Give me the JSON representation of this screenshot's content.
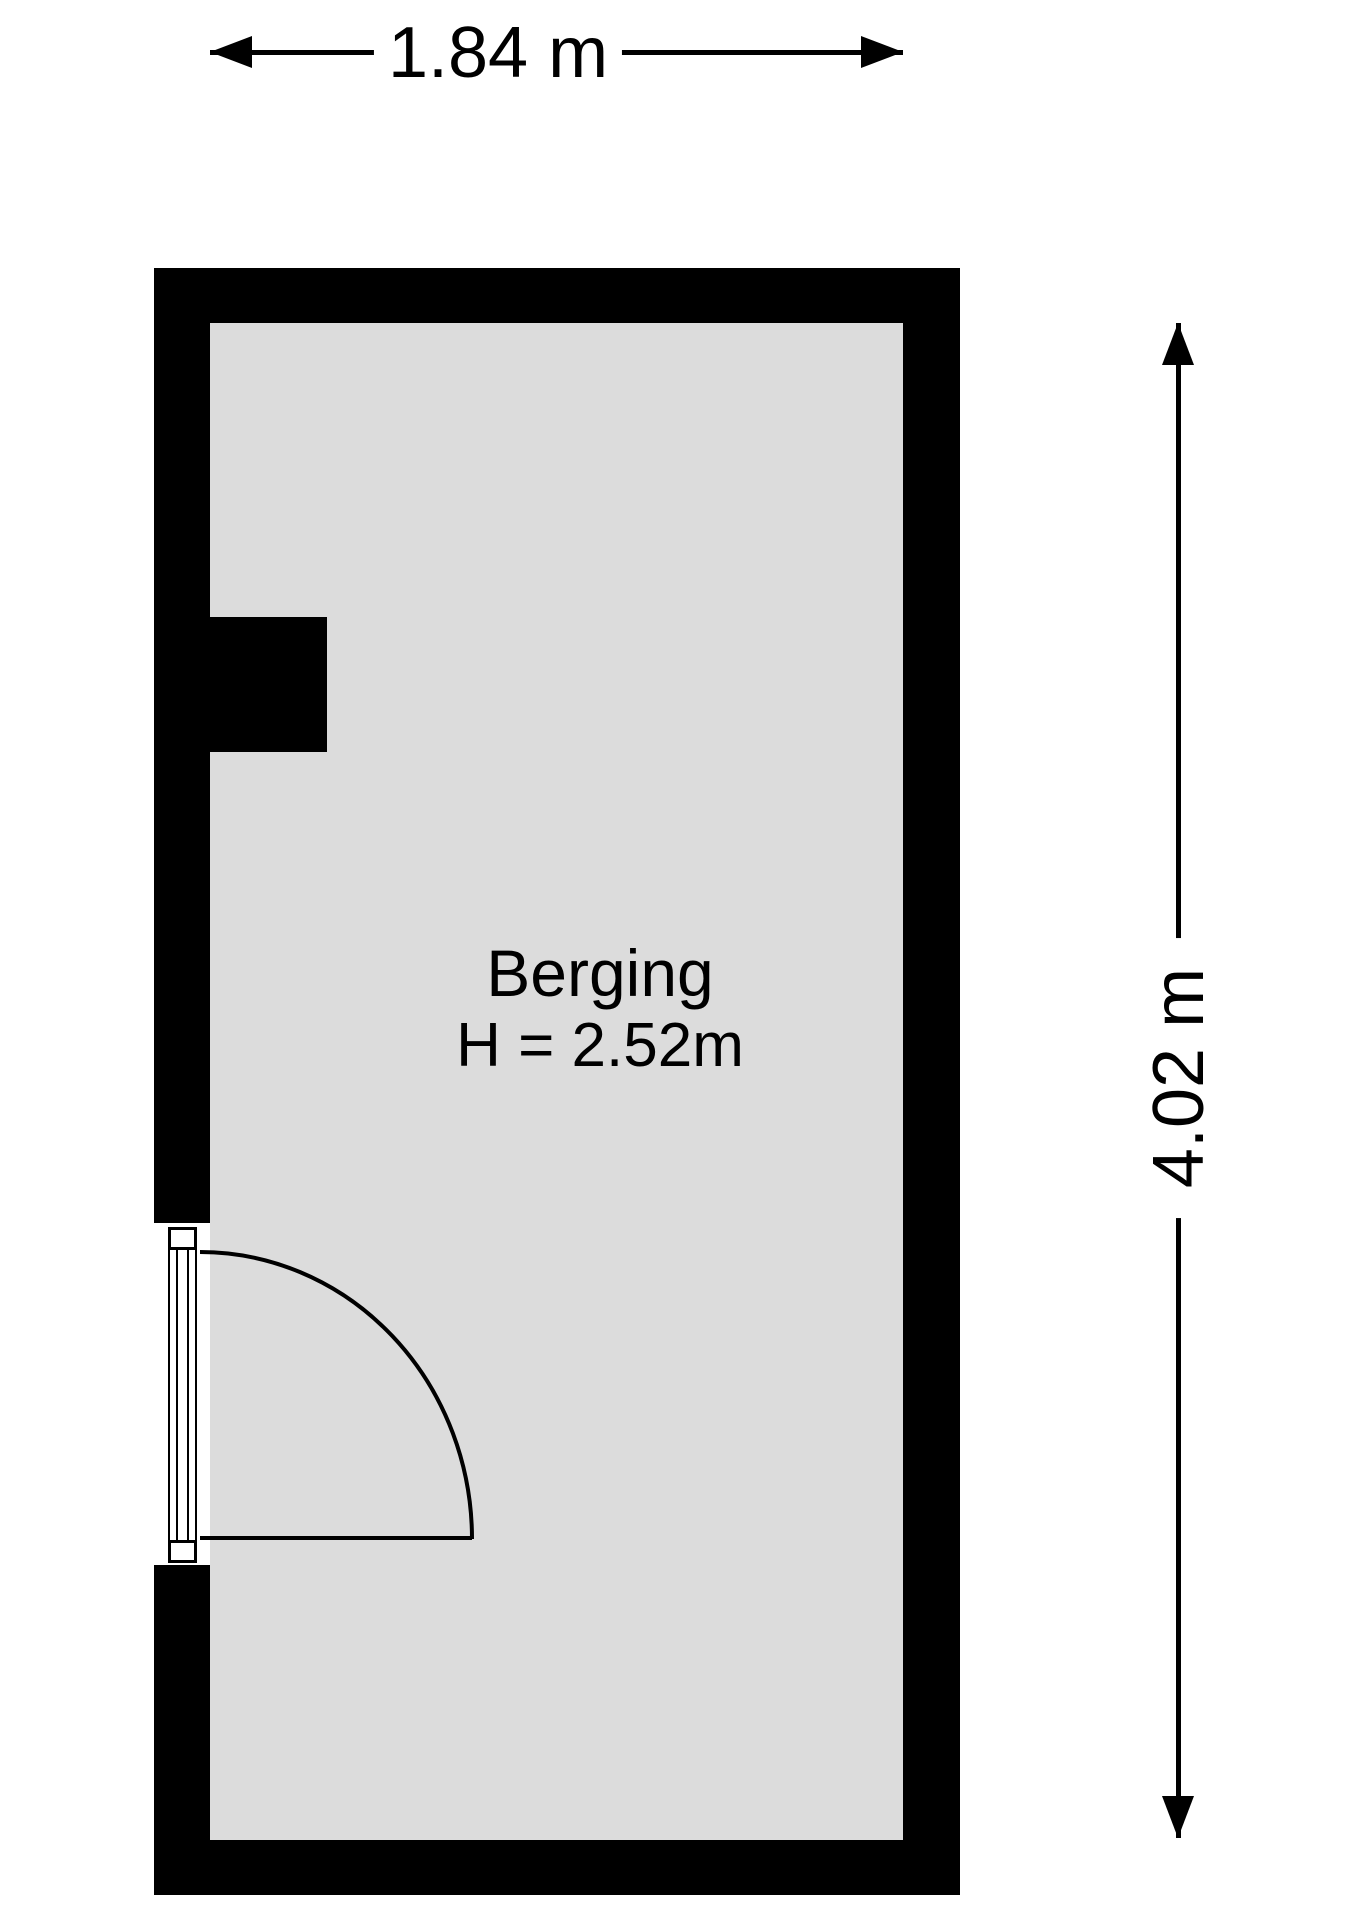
{
  "diagram": {
    "type": "floor-plan",
    "room": {
      "name": "Berging",
      "ceiling_height": "H = 2.52m"
    },
    "dimensions": {
      "width_label": "1.84 m",
      "height_label": "4.02 m"
    },
    "icons": {
      "dimension_arrowheads": "css-triangle",
      "door_swing": "quarter-circle-arc"
    },
    "colors": {
      "wall": "#000000",
      "floor": "#dcdcdc",
      "line": "#000000",
      "background": "#ffffff"
    }
  }
}
